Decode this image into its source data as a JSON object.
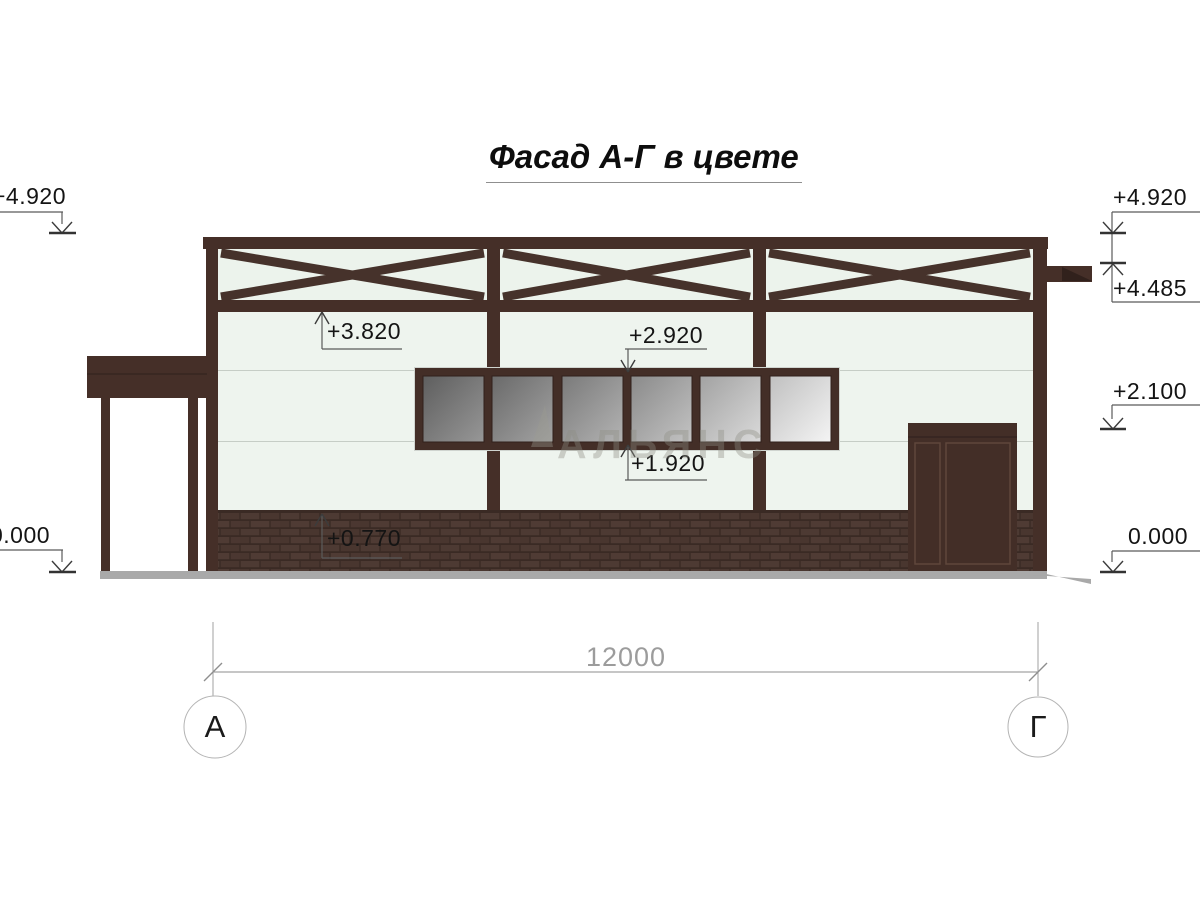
{
  "title": "Фасад А-Г в цвете",
  "elevations": {
    "left_top": "+4.920",
    "left_zero": "0.000",
    "right_top": "+4.920",
    "right_cornice": "+4.485",
    "right_lintel": "+2.100",
    "right_zero": "0.000",
    "truss_bottom": "+3.820",
    "window_top": "+2.920",
    "window_bottom": "+1.920",
    "plinth_top": "+0.770"
  },
  "dimensions": {
    "overall_width": "12000"
  },
  "axes": {
    "left_label": "А",
    "right_label": "Г"
  },
  "watermark": {
    "text": "АЛЬЯНС"
  },
  "colors": {
    "frame_brown": "#452f28",
    "wall_light_green": "#eef4ee",
    "brick_brown": "#4b3832",
    "ground_gray": "#a9a9a9",
    "glass_gray": "#8a8a8a",
    "dimension_gray": "#909090"
  }
}
